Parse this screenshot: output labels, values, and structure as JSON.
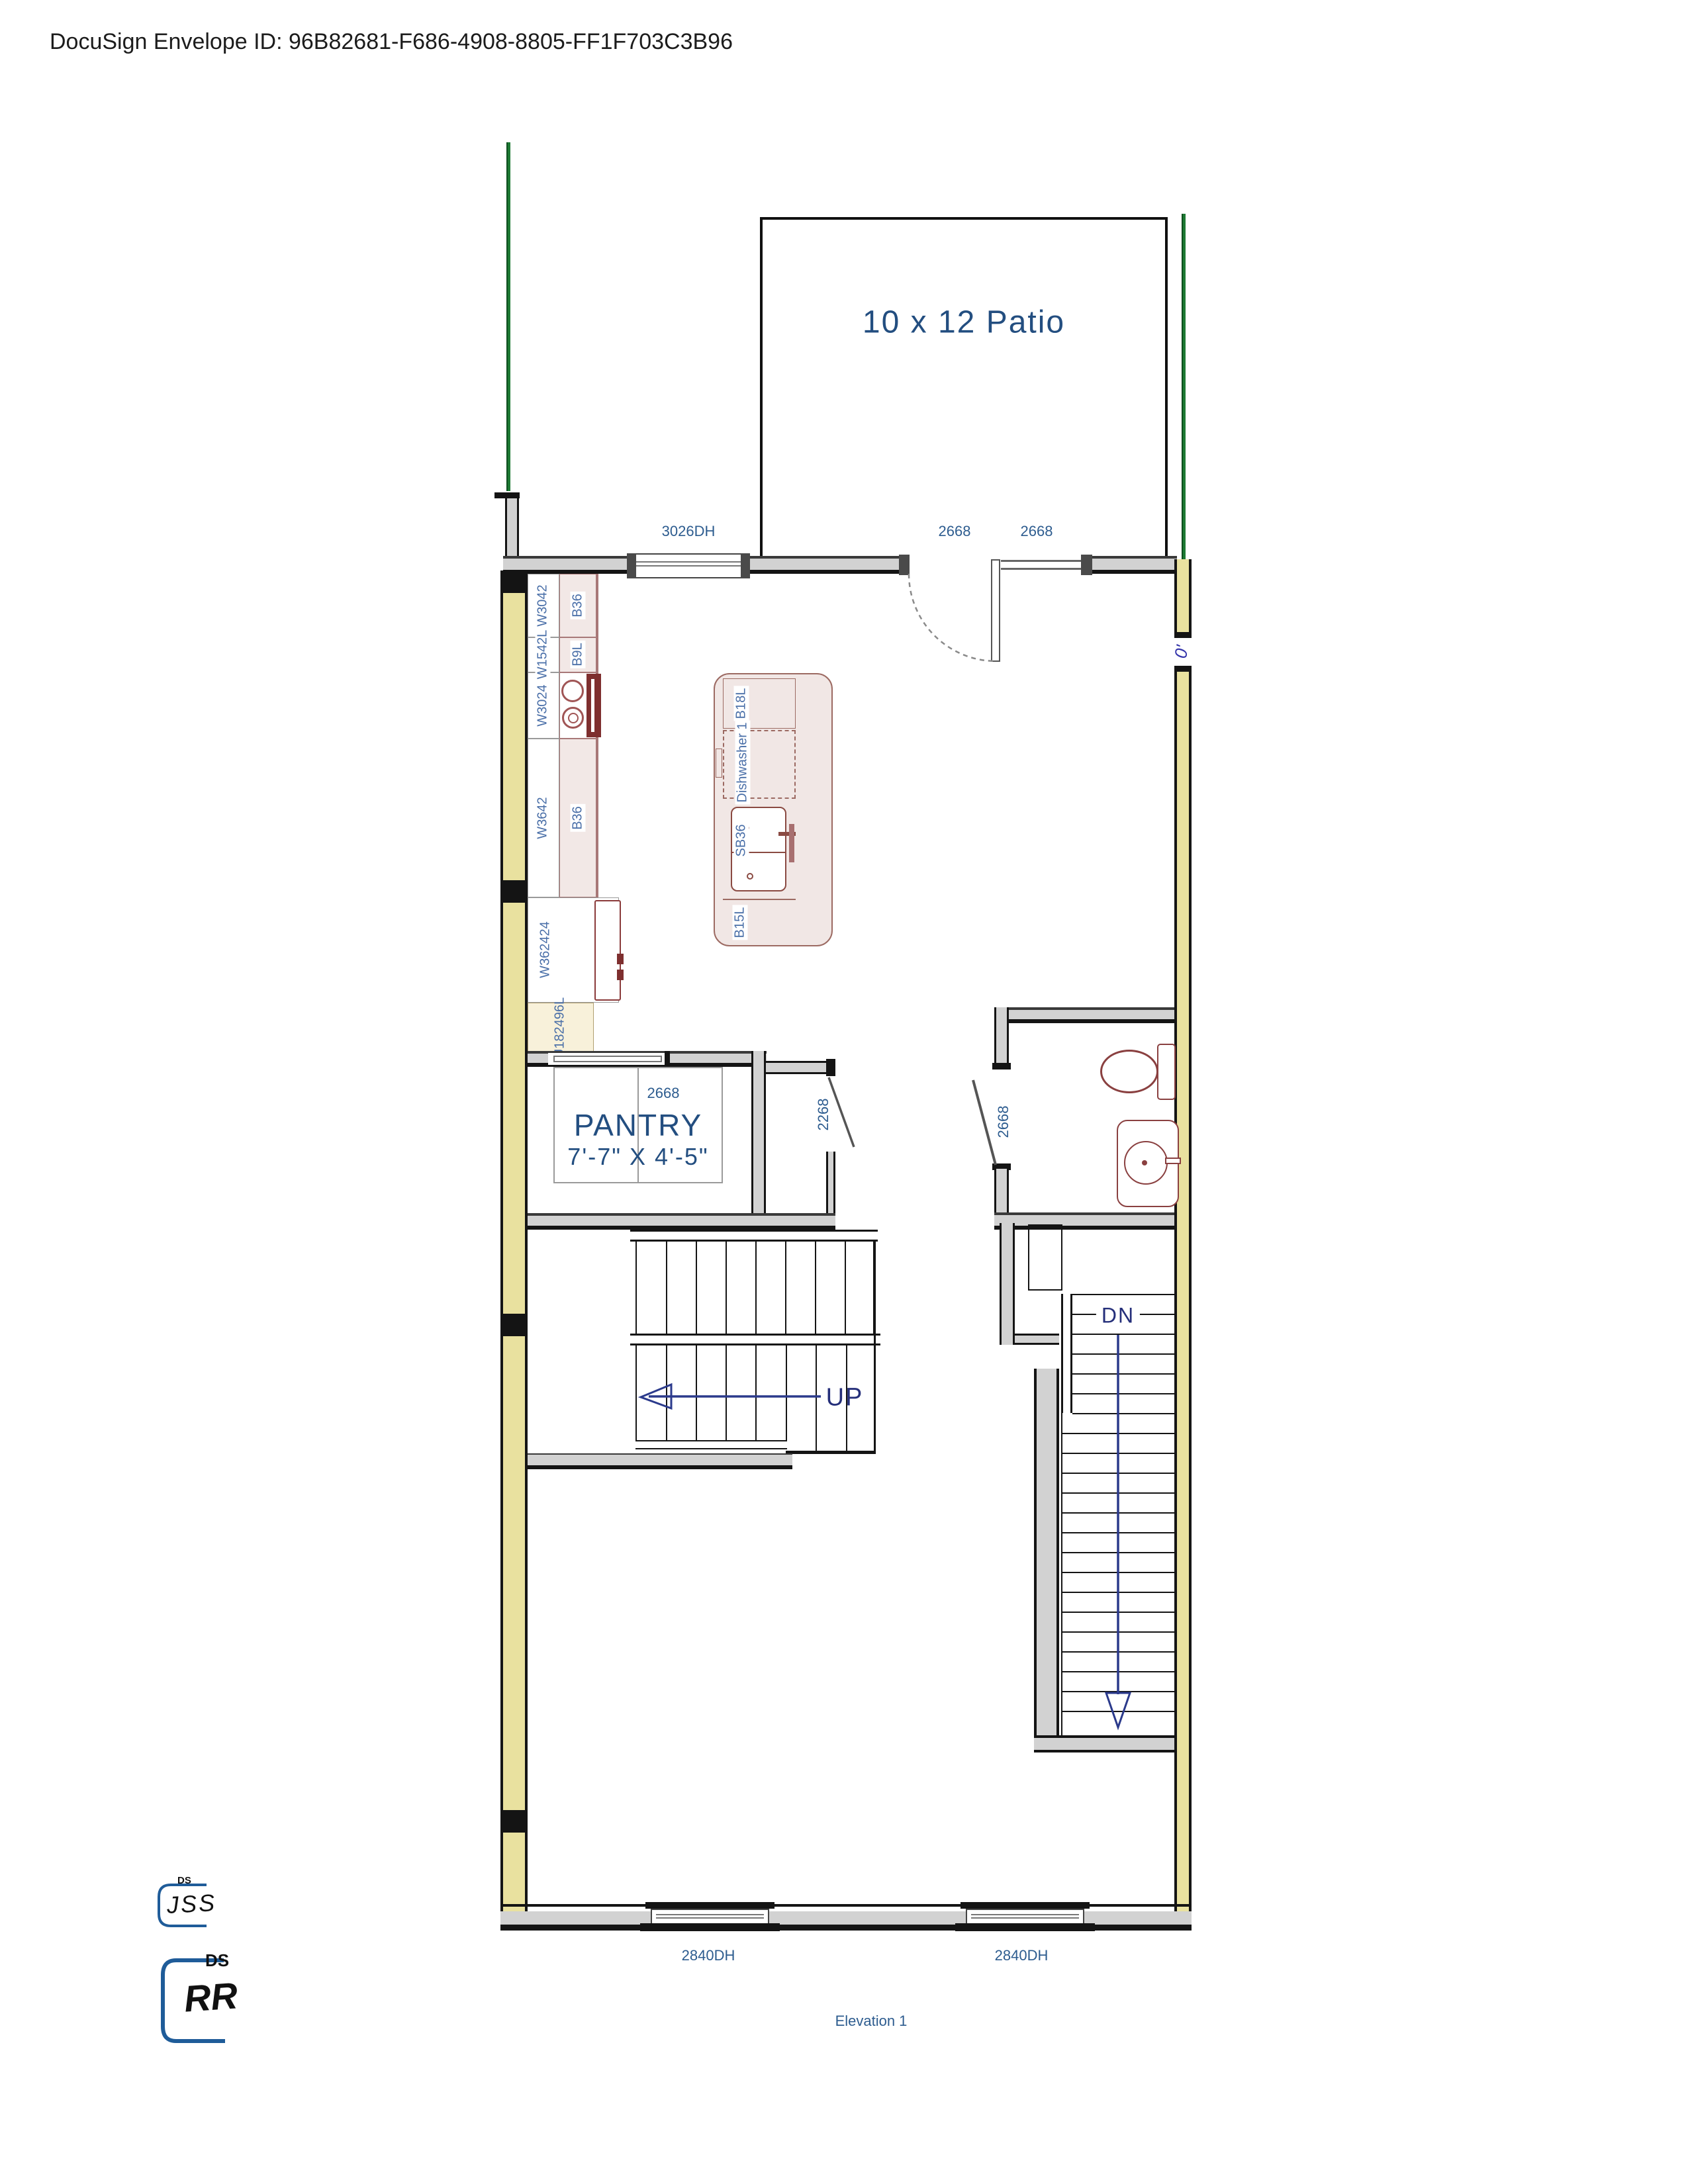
{
  "header": {
    "docusign_envelope": "DocuSign Envelope ID: 96B82681-F686-4908-8805-FF1F703C3B96"
  },
  "plan": {
    "patio_label": "10 x 12 Patio",
    "pantry": {
      "name": "PANTRY",
      "size": "7'-7\" X 4'-5\""
    },
    "stairs": {
      "up": "UP",
      "down": "DN"
    },
    "openings": {
      "top_window": "3026DH",
      "patio_door": "2668",
      "patio_opening": "2668",
      "pantry_door": "2668",
      "hall_closet_door": "2268",
      "bath_door": "2668",
      "bottom_window_left": "2840DH",
      "bottom_window_right": "2840DH",
      "right_wall_mark": "0'"
    },
    "cabinets": {
      "wall_run": [
        "W3042",
        "W1542L",
        "W3024",
        "W3642",
        "W362424",
        "U182496L"
      ],
      "base_run": [
        "B36",
        "B9L",
        "B36"
      ],
      "island": {
        "cabinet_top": "B18L",
        "dishwasher": "Dishwasher 1",
        "sink_base": "SB36",
        "cabinet_bottom": "B15L"
      }
    },
    "caption": "Elevation 1"
  },
  "signatures": {
    "stamp_small": {
      "badge": "DS",
      "initials": "JSS"
    },
    "stamp_large": {
      "badge": "DS",
      "initials": "RR"
    }
  },
  "colors": {
    "label_blue": "#2d5c8f",
    "room_blue": "#234e80",
    "wall_yellow": "#e9e19f",
    "cabinet_pink": "#f2e8e6",
    "fixture_red": "#8a4040",
    "property_green": "#1e7a34",
    "stamp_blue": "#1f5c99",
    "arrow_navy": "#2b3a8c"
  }
}
